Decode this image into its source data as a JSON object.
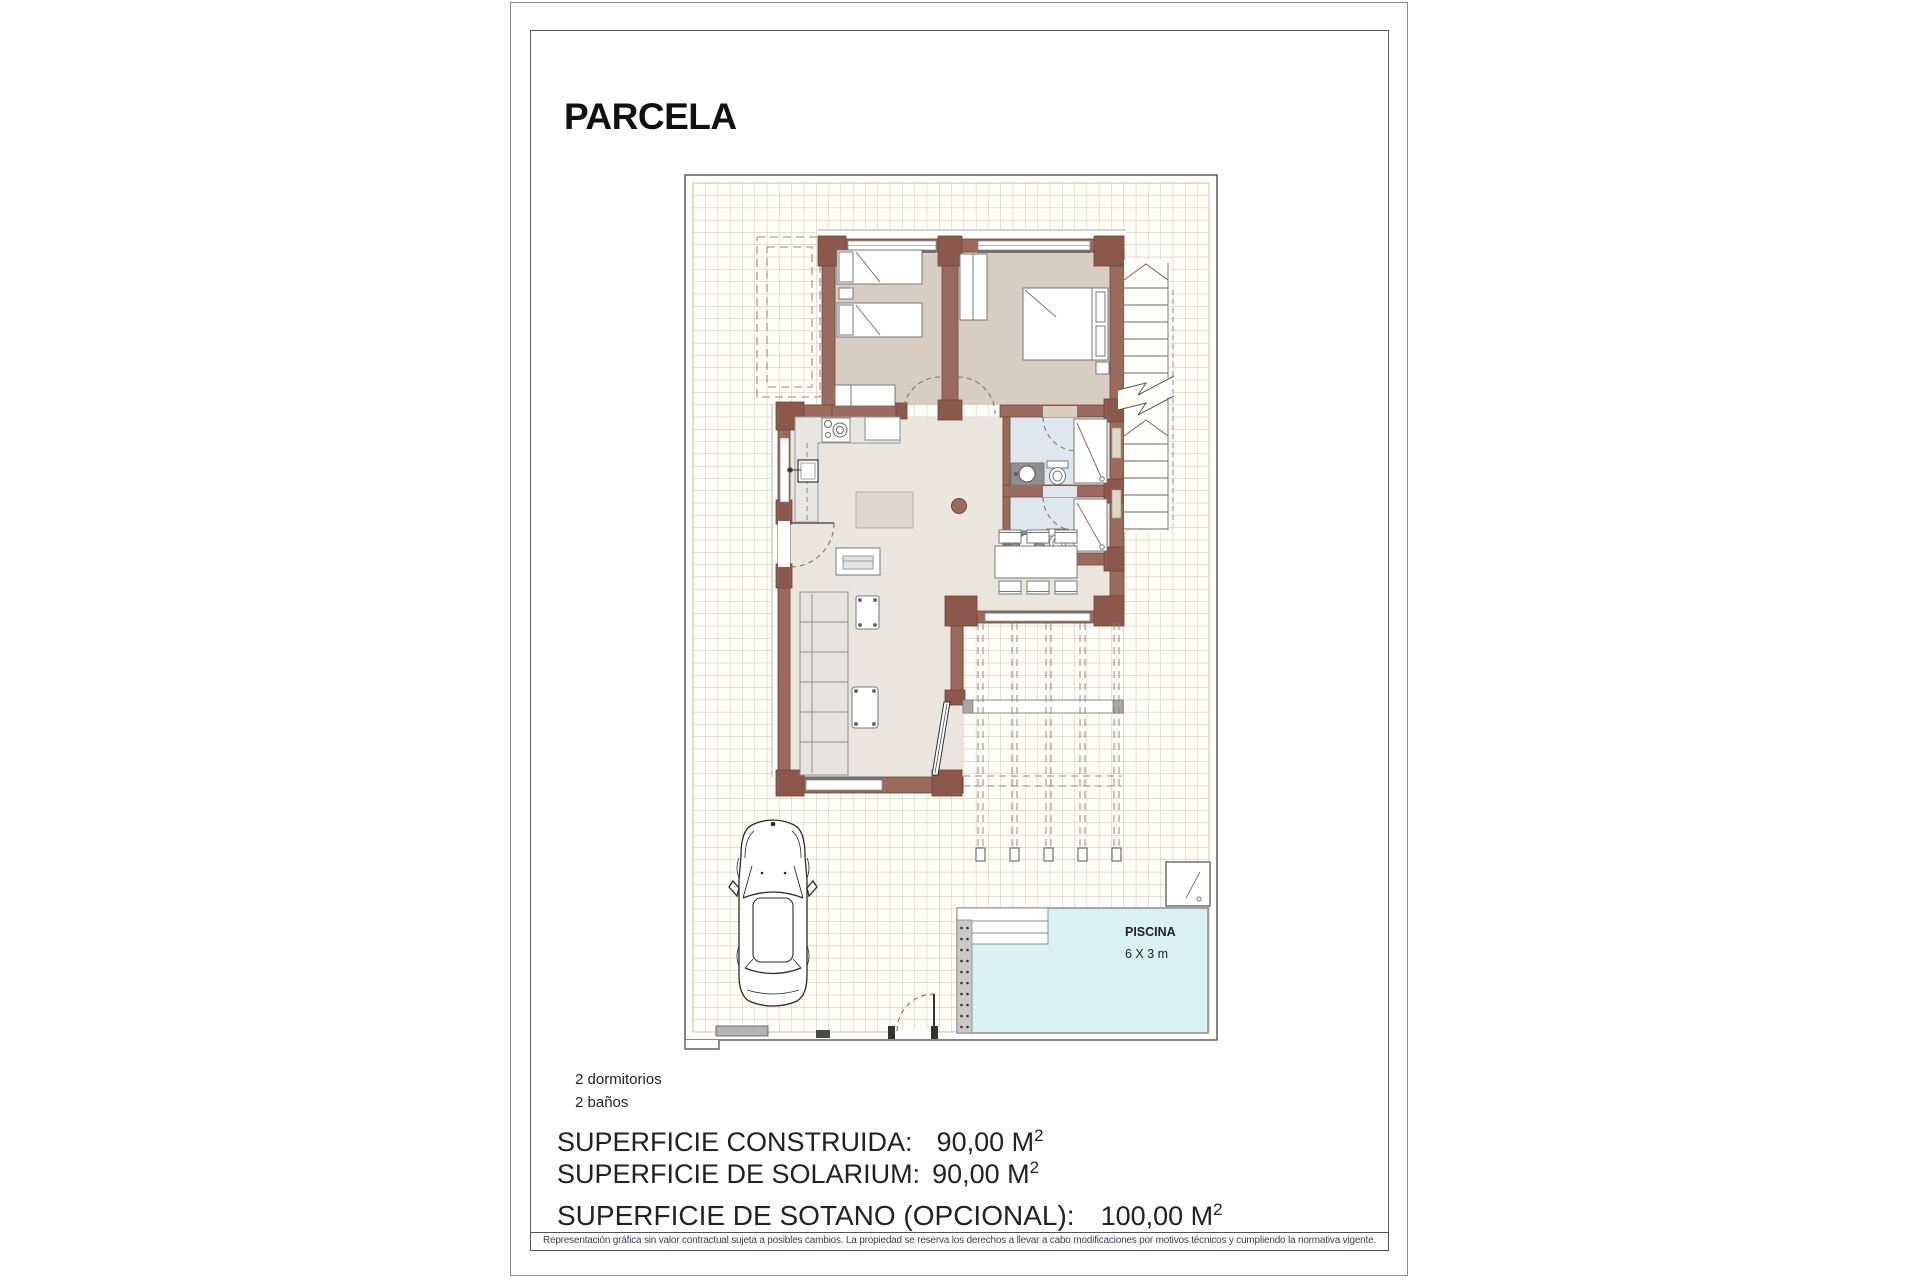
{
  "title": "PARCELA",
  "plan": {
    "pool_label": "PISCINA",
    "pool_size": "6 X 3 m"
  },
  "features": {
    "line1": "2 dormitorios",
    "line2": "2 baños"
  },
  "areas": [
    {
      "label": "SUPERFICIE CONSTRUIDA:",
      "value": "90,00 M",
      "sup": "2"
    },
    {
      "label": "SUPERFICIE DE SOLARIUM:",
      "value": "90,00 M",
      "sup": "2"
    },
    {
      "label": "SUPERFICIE DE SOTANO (OPCIONAL):",
      "value": "100,00 M",
      "sup": "2"
    }
  ],
  "disclaimer": "Representación gráfica sin valor contractual sujeta a posibles cambios. La propiedad se reserva los derechos a llevar a cabo modificaciones por motivos técnicos y cumpliendo la normativa vigente.",
  "colors": {
    "wall": "#9c6a5c",
    "wall_block": "#8d584c",
    "floor_bedroom": "#d8cdc1",
    "floor_bath": "#dfe7ee",
    "floor_living": "#eae6dd",
    "pool": "#daf1f3",
    "grid_line": "#d2bc9d"
  }
}
